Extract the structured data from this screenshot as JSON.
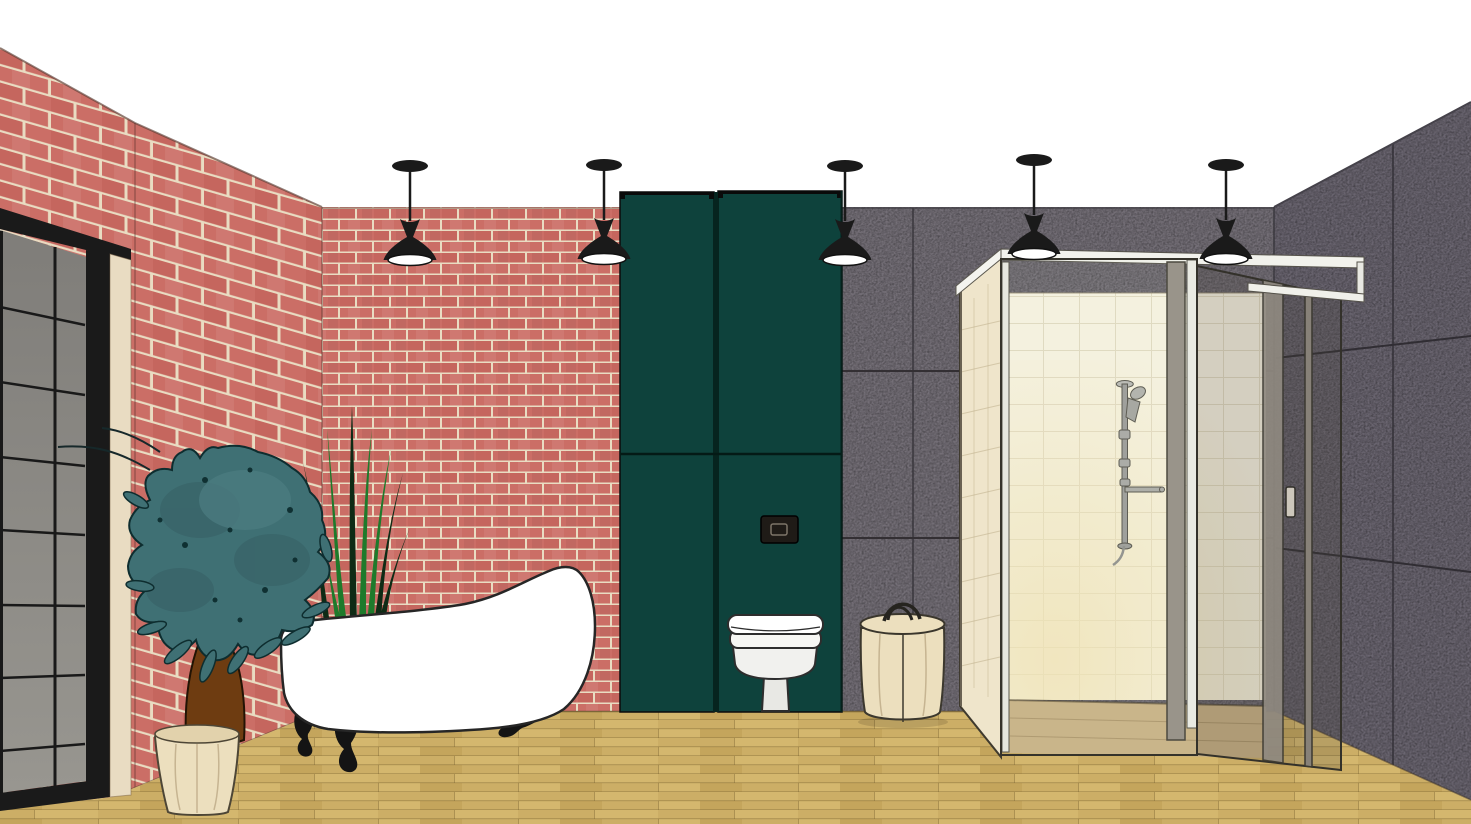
{
  "scene": {
    "kind": "3D interior rendering (CAD / SketchUp style)",
    "room": "Industrial loft bathroom showroom",
    "objects": [
      {
        "name": "glass-partition",
        "desc": "Black steel-framed gridded glass wall, far left"
      },
      {
        "name": "brick-wall-left",
        "desc": "Red brick wall in perspective, left side"
      },
      {
        "name": "brick-wall-back",
        "desc": "Red brick back wall section"
      },
      {
        "name": "teal-wc-panels",
        "desc": "Two full-height dark teal panels with concealed cistern"
      },
      {
        "name": "flush-plate",
        "desc": "Dark rectangular flush plate on right teal panel"
      },
      {
        "name": "wall-hung-toilet",
        "desc": "White toilet below flush plate"
      },
      {
        "name": "wooden-stool-basket",
        "desc": "Cylindrical wooden basket with handle"
      },
      {
        "name": "gray-panel-wall-back",
        "desc": "Speckled gray panel wall with seams"
      },
      {
        "name": "gray-panel-wall-right",
        "desc": "Speckled gray panel wall in perspective, right side"
      },
      {
        "name": "walk-in-shower",
        "desc": "Glass shower enclosure with cream tile lining and slide-rail hand shower"
      },
      {
        "name": "sliding-glass-door",
        "desc": "Framed sliding glass door on right of shower"
      },
      {
        "name": "clawfoot-bathtub",
        "desc": "White slipper bathtub with black feet"
      },
      {
        "name": "potted-tree",
        "desc": "Teal-leaved tree in cream planter"
      },
      {
        "name": "grass-plant",
        "desc": "Tall grass blades behind tub"
      },
      {
        "name": "wood-plank-floor",
        "desc": "Light oak plank floor"
      },
      {
        "name": "pendant-lights",
        "desc": "Black cone pendant lamps",
        "count": 5
      }
    ]
  },
  "lights": {
    "pendants": [
      {
        "x": 410,
        "y": 166
      },
      {
        "x": 604,
        "y": 165
      },
      {
        "x": 845,
        "y": 166
      },
      {
        "x": 1034,
        "y": 160
      },
      {
        "x": 1226,
        "y": 165
      }
    ]
  },
  "palette": {
    "ceiling": "#ffffff",
    "brick1": "#cb6e66",
    "brick2": "#c5665e",
    "mortar": "#e9dcc2",
    "teal": "#0e423c",
    "teal-dark": "#06241f",
    "gray-back": "#746f77",
    "gray-right": "#6a6570",
    "seam": "#2e2c30",
    "wood": "#ccae66",
    "wood2": "#d4b76e",
    "wood3": "#c4a55c",
    "wood-line": "#7c6330",
    "shower-tile": "#f7f2e1",
    "cream-tile": "#efe5cb",
    "pot-cream": "#ecdfbe",
    "glass-top": "#7f7d79",
    "glass-bottom": "#989690",
    "frame-black": "#1a1a1a",
    "fixture-white": "#ffffff",
    "chrome": "#9b9b98",
    "foliage": "#3f7074",
    "foliage-dark": "#0f3032",
    "grass-bright": "#1e7a2b",
    "grass-dark": "#0e2b15",
    "trunk": "#6e3c11"
  }
}
